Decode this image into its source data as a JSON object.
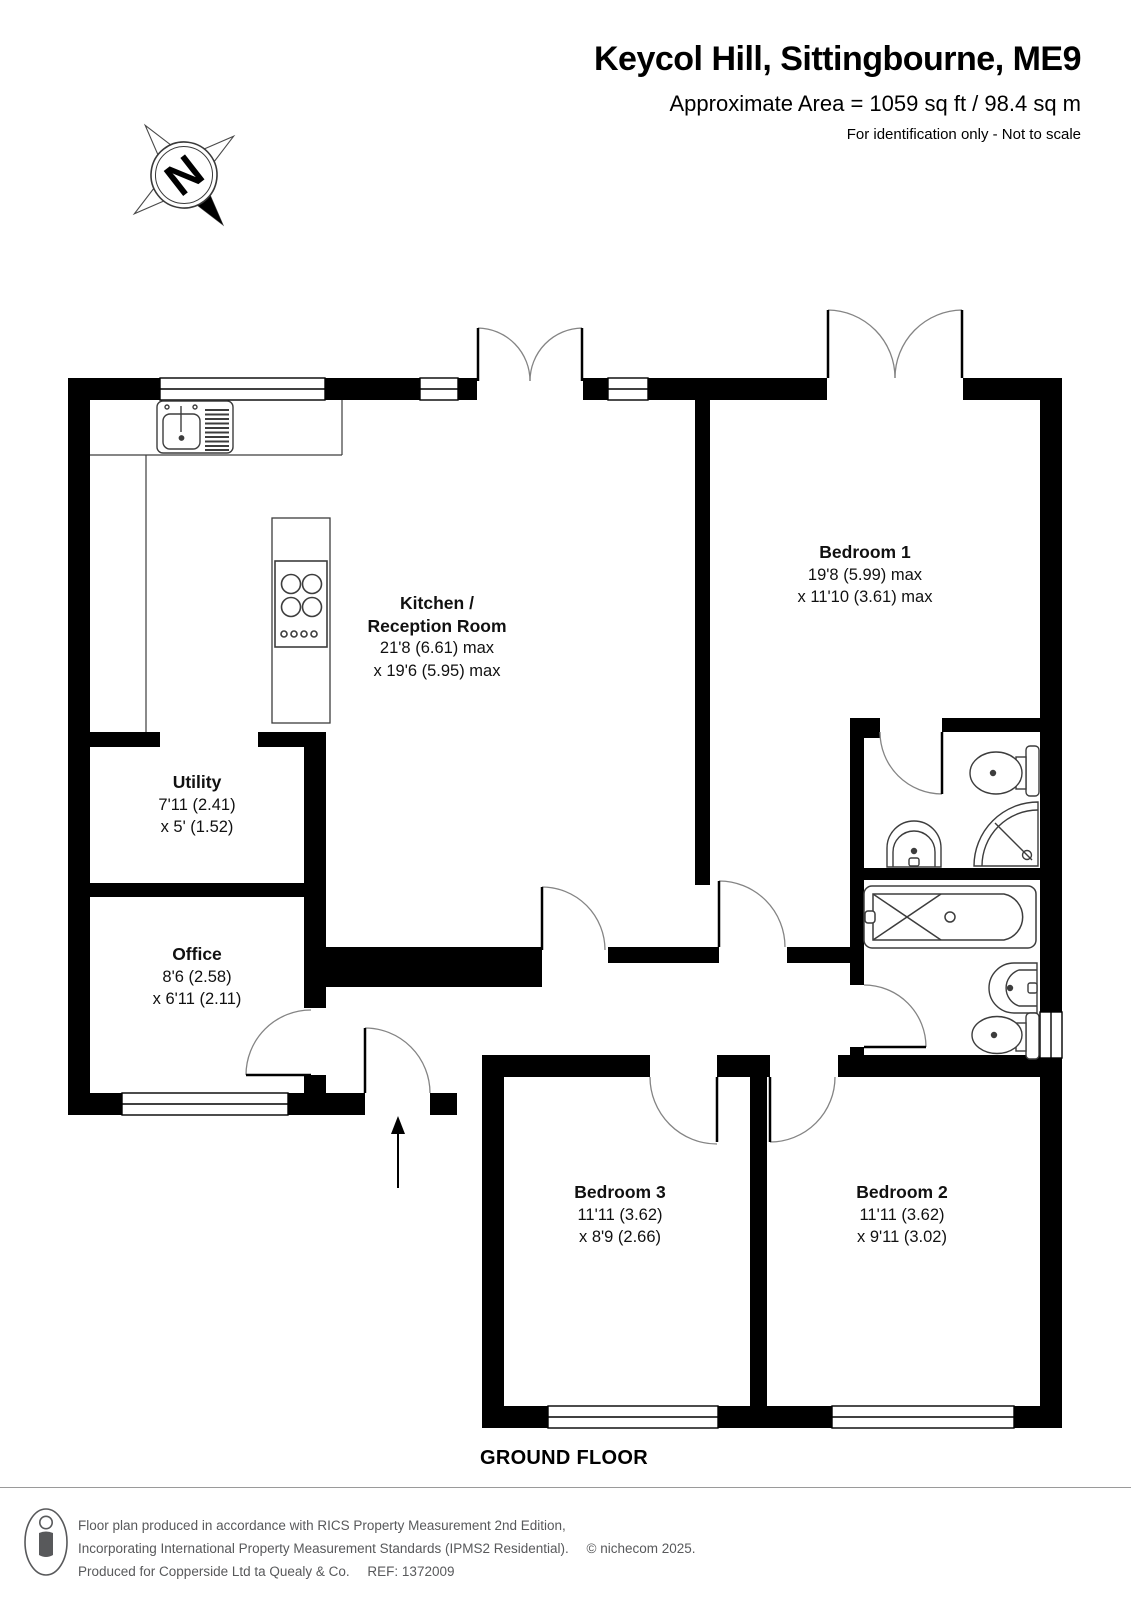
{
  "header": {
    "title": "Keycol Hill, Sittingbourne, ME9",
    "area_line": "Approximate Area = 1059 sq ft / 98.4 sq m",
    "note": "For identification only - Not to scale"
  },
  "compass": {
    "label": "N"
  },
  "rooms": {
    "kitchen": {
      "name_line1": "Kitchen /",
      "name_line2": "Reception Room",
      "dim_line1": "21'8 (6.61) max",
      "dim_line2": "x 19'6 (5.95) max"
    },
    "bedroom1": {
      "name": "Bedroom 1",
      "dim_line1": "19'8 (5.99) max",
      "dim_line2": "x 11'10 (3.61) max"
    },
    "utility": {
      "name": "Utility",
      "dim_line1": "7'11 (2.41)",
      "dim_line2": "x 5' (1.52)"
    },
    "office": {
      "name": "Office",
      "dim_line1": "8'6 (2.58)",
      "dim_line2": "x 6'11 (2.11)"
    },
    "bedroom3": {
      "name": "Bedroom 3",
      "dim_line1": "11'11 (3.62)",
      "dim_line2": "x 8'9 (2.66)"
    },
    "bedroom2": {
      "name": "Bedroom 2",
      "dim_line1": "11'11 (3.62)",
      "dim_line2": "x 9'11 (3.02)"
    }
  },
  "floor_label": "GROUND FLOOR",
  "footer": {
    "line1": "Floor plan produced in accordance with RICS Property Measurement 2nd Edition,",
    "line2": "Incorporating International Property Measurement Standards (IPMS2 Residential).",
    "copyright": "© nichecom 2025.",
    "line3": "Produced for Copperside Ltd ta Quealy & Co.",
    "ref": "REF: 1372009"
  },
  "icons": {
    "compass": "north-compass-rose",
    "entrance": "entrance-arrow",
    "footer_badge": "person-scale-icon"
  },
  "colors": {
    "wall": "#000000",
    "door_arc": "#848484",
    "fixture_line": "#3d3d3d",
    "footer_text": "#58595b"
  }
}
